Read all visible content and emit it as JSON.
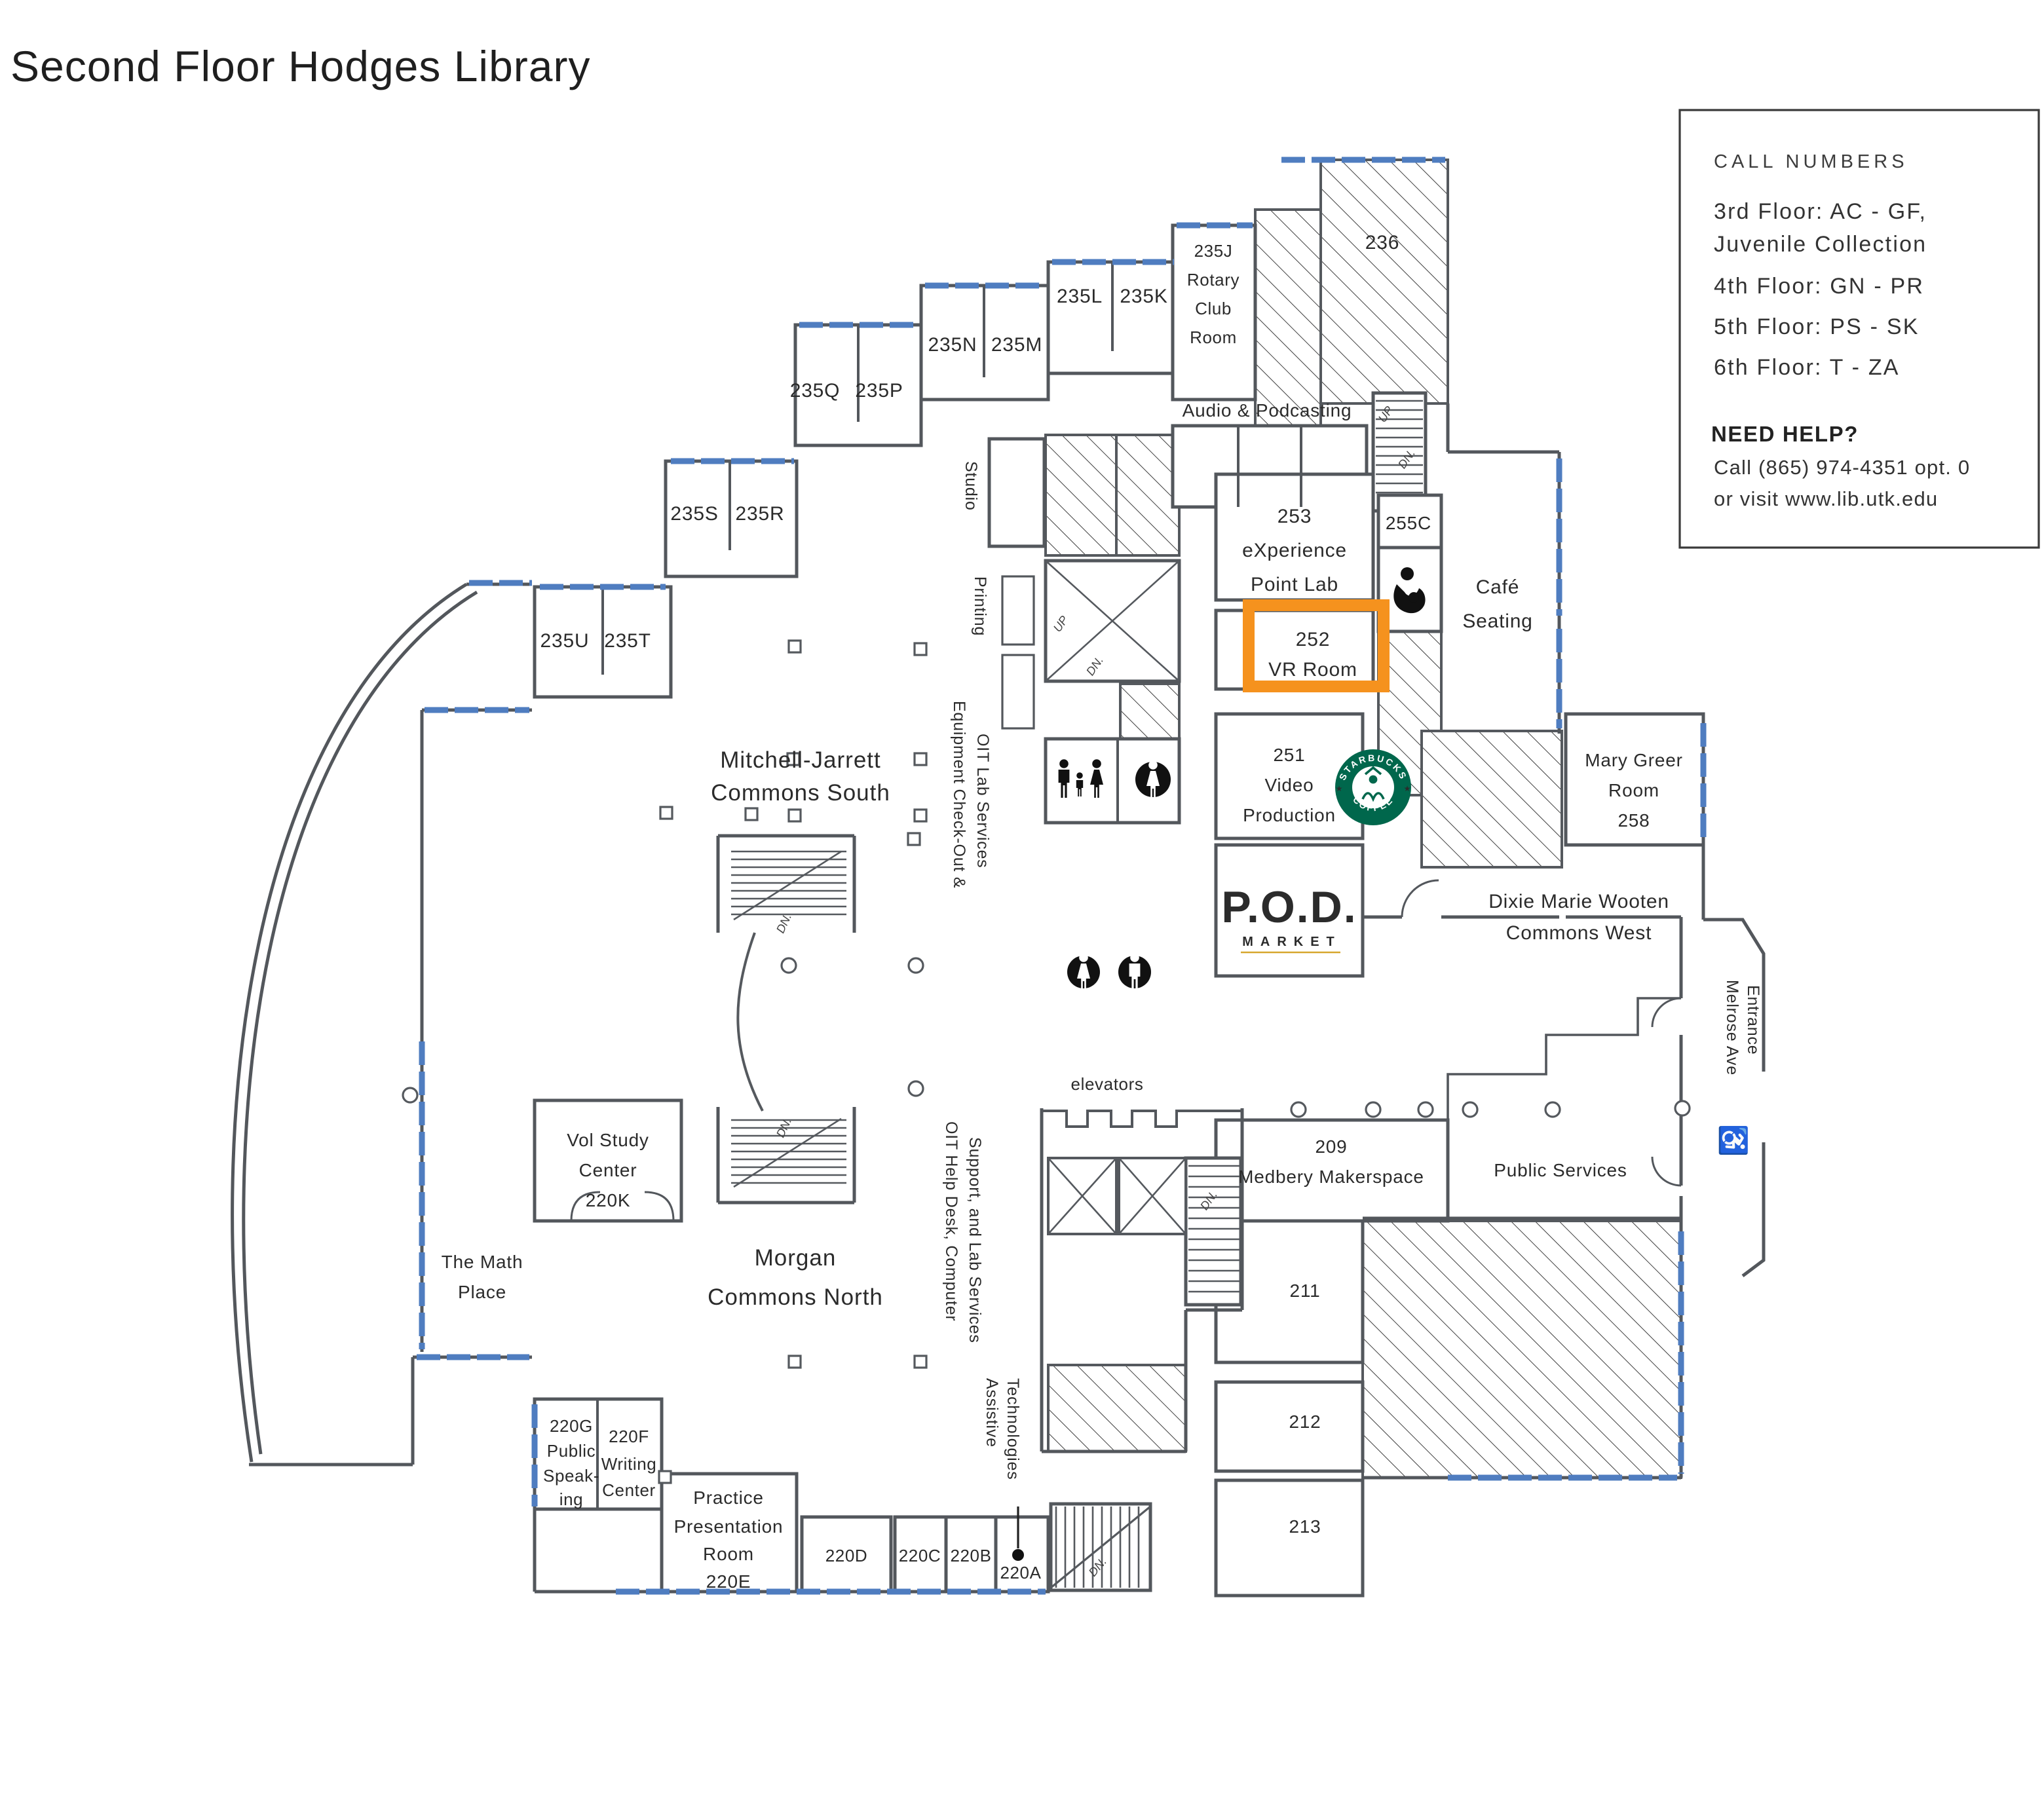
{
  "title": "Second Floor Hodges Library",
  "legend": {
    "heading": "CALL NUMBERS",
    "lines": [
      "3rd Floor: AC - GF,",
      "Juvenile Collection",
      "4th Floor: GN - PR",
      "5th Floor: PS - SK",
      "6th Floor: T - ZA"
    ],
    "help_heading": "NEED HELP?",
    "help_lines": [
      "Call (865) 974-4351 opt. 0",
      "or visit www.lib.utk.edu"
    ]
  },
  "rooms": {
    "q": "235Q",
    "p": "235P",
    "n": "235N",
    "m": "235M",
    "l": "235L",
    "k": "235K",
    "s": "235S",
    "r": "235R",
    "u": "235U",
    "t": "235T",
    "rotary": [
      "235J",
      "Rotary",
      "Club",
      "Room"
    ],
    "big236": "236",
    "lab253": [
      "253",
      "eXperience",
      "Point Lab"
    ],
    "c255": "255C",
    "vr252": [
      "252",
      "VR Room"
    ],
    "video251": [
      "251",
      "Video",
      "Production"
    ],
    "greer": [
      "Mary Greer",
      "Room",
      "258"
    ],
    "makerspace": [
      "209",
      "Medbery Makerspace"
    ],
    "n211": "211",
    "n212": "212",
    "n213": "213",
    "vol": [
      "Vol Study",
      "Center",
      "220K"
    ],
    "g220": [
      "220G",
      "Public",
      "Speak-",
      "ing"
    ],
    "f220": [
      "220F",
      "Writing",
      "Center"
    ],
    "e220": [
      "Practice",
      "Presentation",
      "Room",
      "220E"
    ],
    "d220": "220D",
    "c220": "220C",
    "b220": "220B",
    "a220": "220A"
  },
  "areas": {
    "audio": "Audio & Podcasting",
    "cafe": [
      "Café",
      "Seating"
    ],
    "dixie": [
      "Dixie Marie Wooten",
      "Commons West"
    ],
    "mitchell": [
      "Mitchell-Jarrett",
      "Commons South"
    ],
    "morgan": [
      "Morgan",
      "Commons North"
    ],
    "math": [
      "The Math",
      "Place"
    ],
    "elevators": "elevators",
    "public": "Public Services"
  },
  "vertical": {
    "studio": "Studio",
    "printing": "Printing",
    "equipment": [
      "Equipment Check-Out &",
      "OIT Lab Services"
    ],
    "oit": [
      "OIT Help Desk, Computer",
      "Support, and Lab Services"
    ],
    "assistive": [
      "Assistive",
      "Technologies"
    ],
    "melrose": [
      "Melrose Ave",
      "Entrance"
    ]
  },
  "stairs": {
    "up": "UP",
    "dn": "DN."
  },
  "logos": {
    "starbucks_top": "STARBUCKS",
    "starbucks_bottom": "COFFEE",
    "pod": "P.O.D.",
    "pod_sub": "MARKET"
  },
  "icons": [
    "wheelchair-icon",
    "family-restroom-icon",
    "womens-restroom-icon",
    "mens-restroom-icon",
    "nursing-room-icon",
    "starbucks-logo",
    "pod-market-logo"
  ],
  "colors": {
    "highlight": "#F5921E",
    "window": "#4F7DC0",
    "wall": "#53575C",
    "starbucks_green": "#00674C",
    "pod_green": "#7BA03C",
    "pod_gold": "#D7A72E"
  },
  "accessibility_symbol": "♿"
}
